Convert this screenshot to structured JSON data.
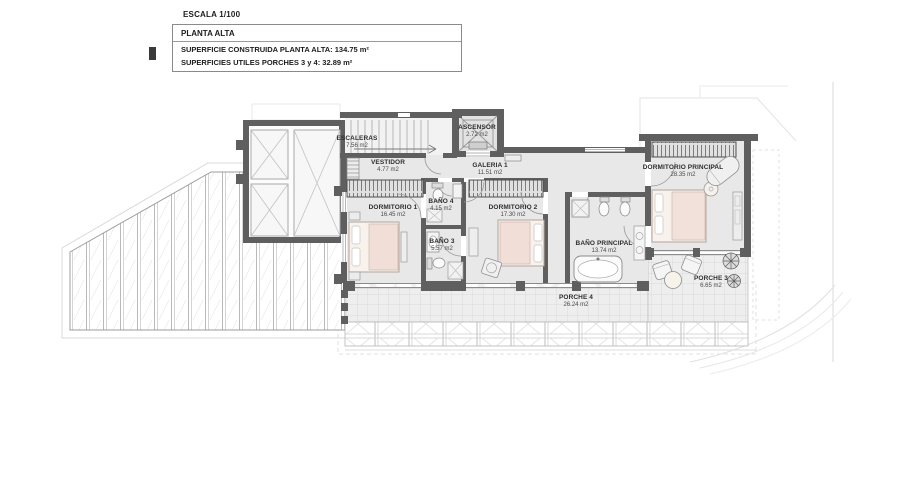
{
  "title_block": {
    "escala": "ESCALA 1/100",
    "floor": "PLANTA ALTA",
    "line1": "SUPERFICIE CONSTRUIDA PLANTA ALTA: 134.75 m²",
    "line2": "SUPERFICIES UTILES PORCHES 3 y 4: 32.89 m²"
  },
  "rooms": {
    "escaleras": {
      "label": "ESCALERAS",
      "area": "7.56 m2"
    },
    "ascensor": {
      "label": "ASCENSOR",
      "area": "2.72 m2"
    },
    "vestidor": {
      "label": "VESTIDOR",
      "area": "4.77 m2"
    },
    "galeria": {
      "label": "GALERIA 1",
      "area": "11.51 m2"
    },
    "dormitorio1": {
      "label": "DORMITORIO 1",
      "area": "16.45 m2"
    },
    "bano4": {
      "label": "BAÑO 4",
      "area": "4.15 m2"
    },
    "bano3": {
      "label": "BAÑO 3",
      "area": "5.57 m2"
    },
    "dormitorio2": {
      "label": "DORMITORIO 2",
      "area": "17.30 m2"
    },
    "banoprincipal": {
      "label": "BAÑO PRINCIPAL",
      "area": "13.74 m2"
    },
    "dormprincipal": {
      "label": "DORMITORIO PRINCIPAL",
      "area": "28.35 m2"
    },
    "porche4": {
      "label": "PORCHE 4",
      "area": "26.24 m2"
    },
    "porche3": {
      "label": "PORCHE 3",
      "area": "6.65 m2"
    }
  },
  "watermark": {
    "line1": "STRAUS",
    "line2": "INTERNATIONAL",
    "line3": "strausinternational.com"
  },
  "colors": {
    "wall": "#5f5f5f",
    "floor": "#e8e8e8",
    "bed": "#f1ded6",
    "line": "#9a9a9a"
  }
}
